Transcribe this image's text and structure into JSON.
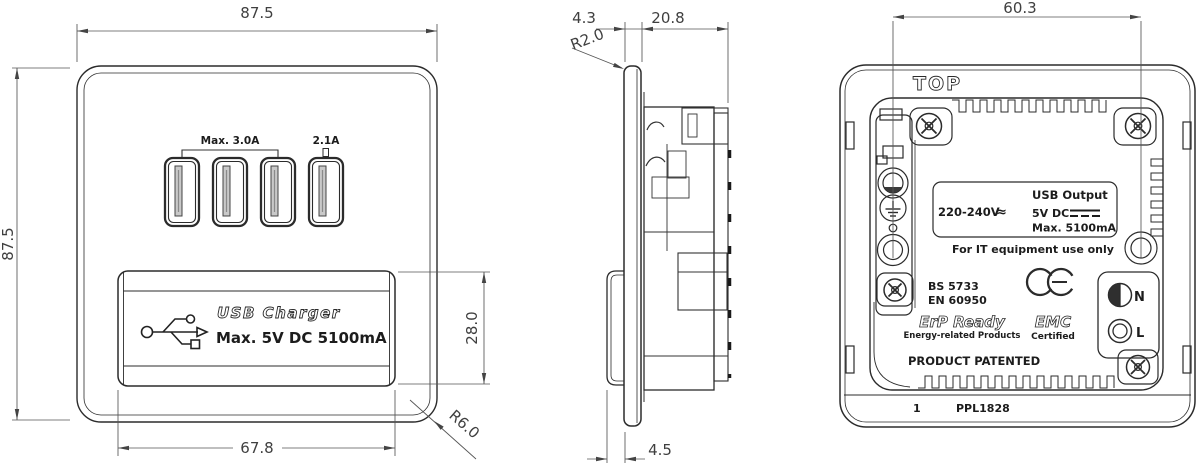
{
  "drawing": {
    "front_view": {
      "dim_width": "87.5",
      "dim_height": "87.5",
      "usb_group_rating": "Max. 3.0A",
      "usb_port4_rating": "2.1A",
      "label_title": "USB  Charger",
      "label_rating": "Max. 5V DC 5100mA",
      "dim_label_width": "67.8",
      "dim_label_height": "28.0",
      "corner_radius_callout": "R6.0"
    },
    "side_view": {
      "dim_faceplate_thickness": "4.3",
      "dim_body_depth": "20.8",
      "edge_radius_callout": "R2.0",
      "dim_label_protrusion": "4.5"
    },
    "back_view": {
      "dim_fixing_centres": "60.3",
      "orientation_label": "TOP",
      "rating_plate": {
        "input_voltage": "220-240V",
        "ac_symbol": "≈",
        "output_title": "USB Output",
        "output_voltage": "5V DC",
        "output_current": "Max. 5100mA"
      },
      "it_note": "For IT equipment use only",
      "standard_1": "BS 5733",
      "standard_2": "EN 60950",
      "erp_title": "ErP Ready",
      "erp_subtitle": "Energy-related Products",
      "emc_title": "EMC",
      "emc_subtitle": "Certified",
      "patent_note": "PRODUCT PATENTED",
      "terminal_neutral_label": "N",
      "terminal_live_label": "L",
      "footer_sheet": "1",
      "footer_code": "PPL1828"
    },
    "icons": {
      "usb_trident": "usb-trident-icon",
      "dc_symbol": "solid-over-dashed-line",
      "ce_mark": "CE",
      "earth_symbol": "ground-lines"
    },
    "colors": {
      "line": "#2b2b2b",
      "dimension": "#4a4a4a",
      "tongue_fill": "#c9c9c9",
      "background": "#ffffff"
    }
  }
}
